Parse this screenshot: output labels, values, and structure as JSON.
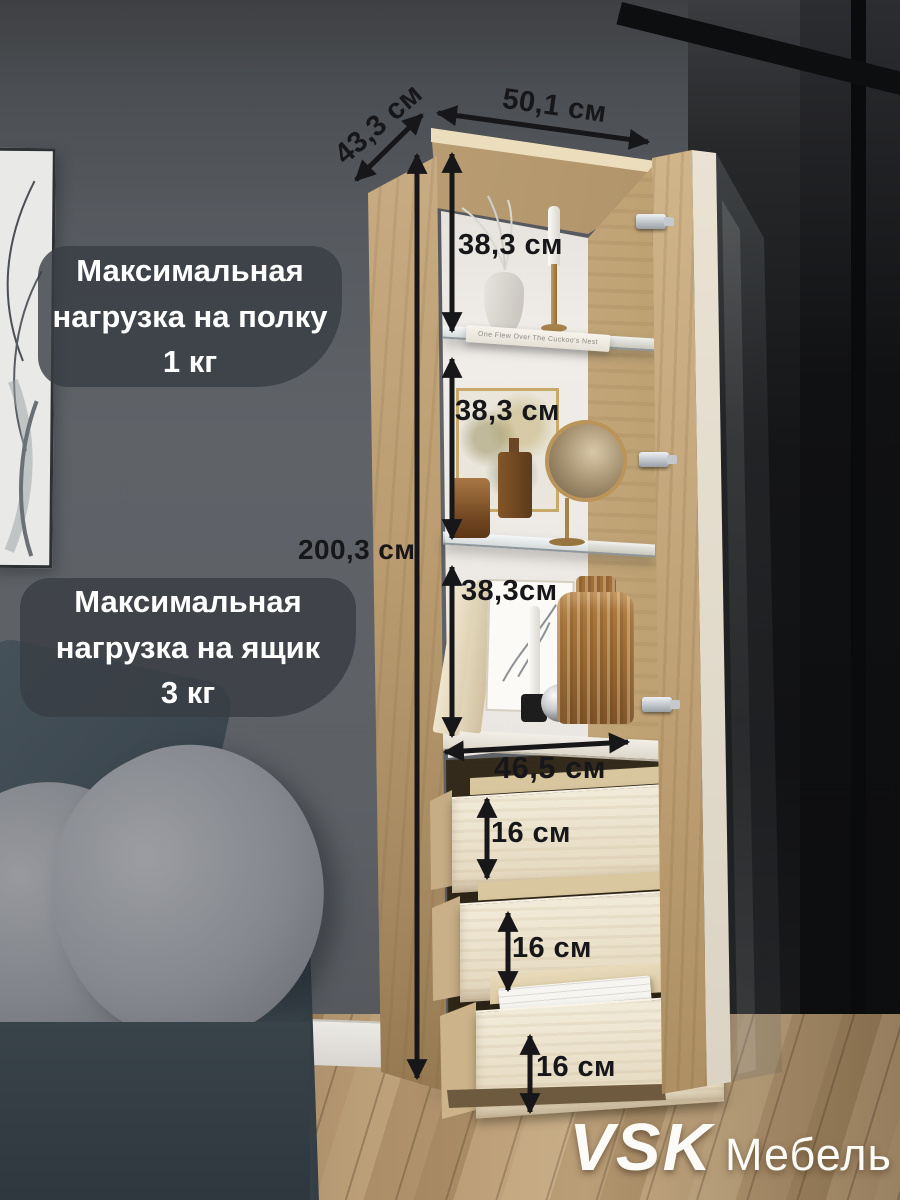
{
  "callouts": {
    "shelf_load": "Максимальная\nнагрузка на полку\n1 кг",
    "drawer_load": "Максимальная\nнагрузка на ящик\n3 кг"
  },
  "dimensions": {
    "depth": "43,3 см",
    "width": "50,1 см",
    "height": "200,3 см",
    "section_top": "38,3 см",
    "section_middle": "38,3 см",
    "section_bottom": "38,3см",
    "inner_width": "46,5 см",
    "drawer_top": "16 см",
    "drawer_middle": "16 см",
    "drawer_bottom": "16 см"
  },
  "decor": {
    "book_spine": "One Flew Over The Cuckoo's Nest"
  },
  "brand": {
    "name": "VSK",
    "suffix": "Мебель"
  },
  "colors": {
    "annotation": "#17171a",
    "callout_bg": "rgba(56,61,67,0.8)",
    "wall": "#5d6166",
    "wood": "#c7ab82",
    "drawer_wood": "#ecdfc5",
    "floor": "#b5976f",
    "sofa": "#3d474e",
    "partition": "#131416"
  }
}
